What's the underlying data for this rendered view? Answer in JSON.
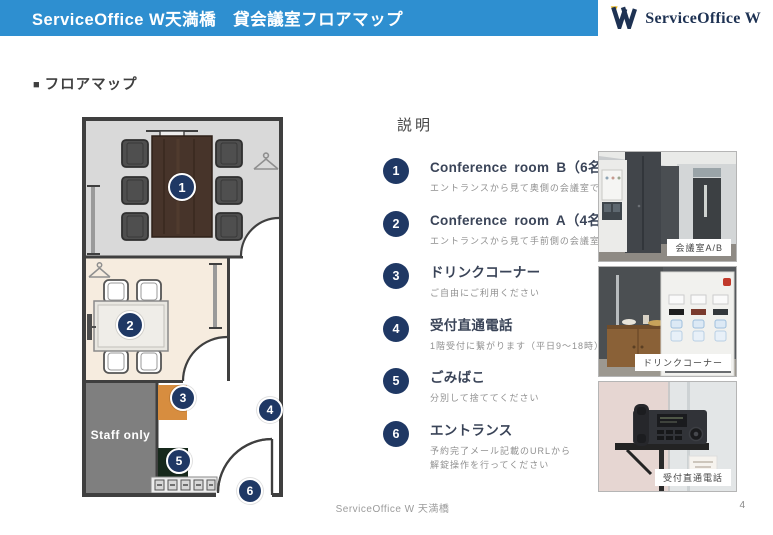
{
  "colors": {
    "header_blue": "#2E8FD0",
    "marker_navy": "#1F3864",
    "logo_navy": "#1E3253",
    "logo_gold": "#EBB410",
    "wall": "#3F3F3F",
    "room_b_bg": "#D9D9D9",
    "room_a_bg": "#F6ECDF",
    "staff_gray": "#7F7F7F",
    "drink_orange": "#D78D3F",
    "trash_dark_green": "#17291C"
  },
  "header": {
    "title": "ServiceOffice W天満橋　貸会議室フロアマップ",
    "logo_text": "ServiceOffice W"
  },
  "section": {
    "bullet": "■",
    "title": "フロアマップ"
  },
  "floorplan": {
    "staff_label": "Staff only",
    "markers": [
      "1",
      "2",
      "3",
      "4",
      "5",
      "6"
    ]
  },
  "legend": {
    "heading": "説明",
    "items": [
      {
        "num": "1",
        "title": "Conference room B（6名）",
        "desc": "エントランスから見て奥側の会議室です"
      },
      {
        "num": "2",
        "title": "Conference room A（4名）",
        "desc": "エントランスから見て手前側の会議室です"
      },
      {
        "num": "3",
        "title": "ドリンクコーナー",
        "desc": "ご自由にご利用ください"
      },
      {
        "num": "4",
        "title": "受付直通電話",
        "desc": "1階受付に繋がります（平日9～18時）"
      },
      {
        "num": "5",
        "title": "ごみばこ",
        "desc": "分別して捨ててください"
      },
      {
        "num": "6",
        "title": "エントランス",
        "desc": "予約完了メール記載のURLから",
        "desc2": "解錠操作を行ってください"
      }
    ]
  },
  "photos": [
    {
      "caption": "会議室A/B"
    },
    {
      "caption": "ドリンクコーナー"
    },
    {
      "caption": "受付直通電話"
    }
  ],
  "footer": {
    "text": "ServiceOffice W 天満橋",
    "page_number": "4"
  }
}
